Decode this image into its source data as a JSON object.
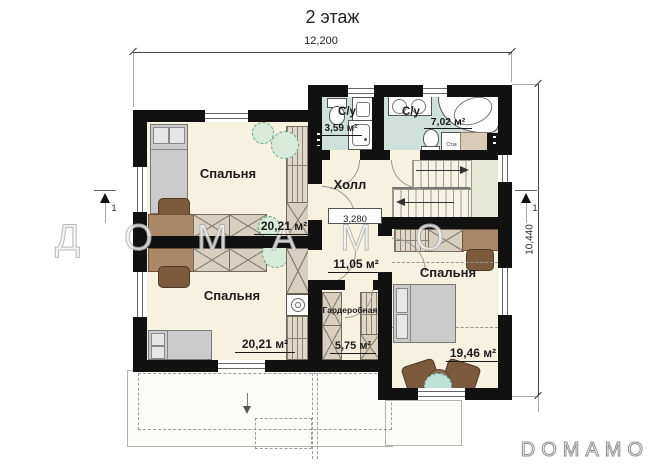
{
  "title": "2 этаж",
  "watermark": "ДОМАМО",
  "brand": {
    "logo": "DOMAMO"
  },
  "dimensions": {
    "overall_width": "12,200",
    "overall_height": "10,440",
    "hall_width": "3,280"
  },
  "section_marks": {
    "left": "1",
    "right": "1"
  },
  "rooms": {
    "bedroom_top_left": {
      "name": "Спальня",
      "area": "20,21 м²"
    },
    "bedroom_bottom_left": {
      "name": "Спальня",
      "area": "20,21 м²"
    },
    "bathroom_small": {
      "name": "С/у",
      "area": "3,59 м²"
    },
    "bathroom_large": {
      "name": "С/у",
      "area": "7,02 м²"
    },
    "hall": {
      "name": "Холл",
      "area": "11,05 м²"
    },
    "wardrobe": {
      "name": "Гардеробная",
      "area": "5,75 м²"
    },
    "bedroom_right": {
      "name": "Спальня",
      "area": "19,46 м²"
    }
  },
  "appliances": {
    "washing_machine": "Ст.м"
  },
  "colors": {
    "wall": "#111111",
    "room_floor": "#f7f2df",
    "bathroom_floor": "#cfe0db",
    "stair_landing": "#e6e8d6",
    "furniture_wood": "#a9886a",
    "furniture_dark_wood": "#7b5a3e",
    "furniture_gray": "#cbcbcb",
    "plant_green": "#69a183"
  }
}
